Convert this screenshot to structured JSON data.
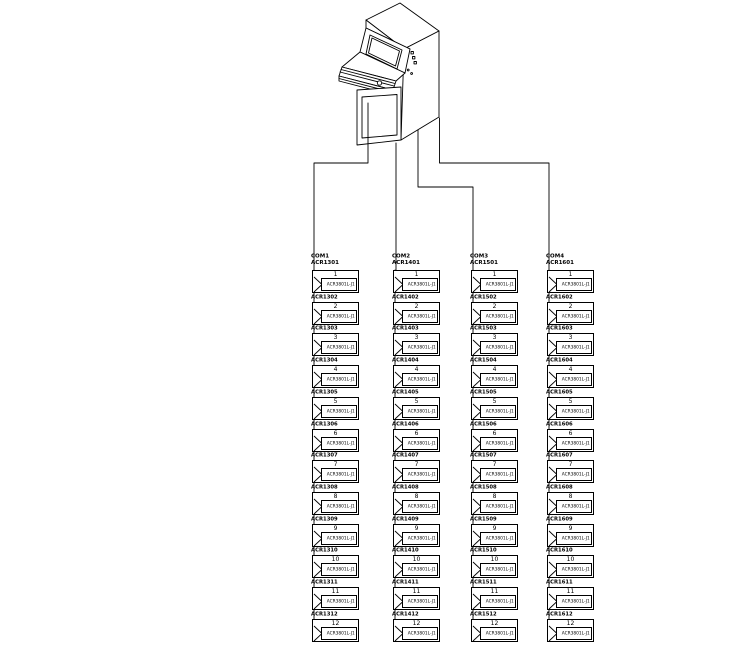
{
  "diagram": {
    "title": "operator-console-to-reader-loops wiring diagram",
    "console": {
      "name": "operator-console"
    },
    "line_color": "#000000",
    "background": "#ffffff",
    "columns": [
      {
        "com": "COM1",
        "units": [
          {
            "no": "1",
            "tag": "ACR1301",
            "model": "ACR3801L-J1"
          },
          {
            "no": "2",
            "tag": "ACR1302",
            "model": "ACR3801L-J1"
          },
          {
            "no": "3",
            "tag": "ACR1303",
            "model": "ACR3801L-J1"
          },
          {
            "no": "4",
            "tag": "ACR1304",
            "model": "ACR3801L-J1"
          },
          {
            "no": "5",
            "tag": "ACR1305",
            "model": "ACR3801L-J1"
          },
          {
            "no": "6",
            "tag": "ACR1306",
            "model": "ACR3801L-J1"
          },
          {
            "no": "7",
            "tag": "ACR1307",
            "model": "ACR3801L-J1"
          },
          {
            "no": "8",
            "tag": "ACR1308",
            "model": "ACR3801L-J1"
          },
          {
            "no": "9",
            "tag": "ACR1309",
            "model": "ACR3801L-J1"
          },
          {
            "no": "10",
            "tag": "ACR1310",
            "model": "ACR3801L-J1"
          },
          {
            "no": "11",
            "tag": "ACR1311",
            "model": "ACR3801L-J1"
          },
          {
            "no": "12",
            "tag": "ACR1312",
            "model": "ACR3801L-J1"
          }
        ]
      },
      {
        "com": "COM2",
        "units": [
          {
            "no": "1",
            "tag": "ACR1401",
            "model": "ACR3801L-J1"
          },
          {
            "no": "2",
            "tag": "ACR1402",
            "model": "ACR3801L-J1"
          },
          {
            "no": "3",
            "tag": "ACR1403",
            "model": "ACR3801L-J1"
          },
          {
            "no": "4",
            "tag": "ACR1404",
            "model": "ACR3801L-J1"
          },
          {
            "no": "5",
            "tag": "ACR1405",
            "model": "ACR3801L-J1"
          },
          {
            "no": "6",
            "tag": "ACR1406",
            "model": "ACR3801L-J1"
          },
          {
            "no": "7",
            "tag": "ACR1407",
            "model": "ACR3801L-J1"
          },
          {
            "no": "8",
            "tag": "ACR1408",
            "model": "ACR3801L-J1"
          },
          {
            "no": "9",
            "tag": "ACR1409",
            "model": "ACR3801L-J1"
          },
          {
            "no": "10",
            "tag": "ACR1410",
            "model": "ACR3801L-J1"
          },
          {
            "no": "11",
            "tag": "ACR1411",
            "model": "ACR3801L-J1"
          },
          {
            "no": "12",
            "tag": "ACR1412",
            "model": "ACR3801L-J1"
          }
        ]
      },
      {
        "com": "COM3",
        "units": [
          {
            "no": "1",
            "tag": "ACR1501",
            "model": "ACR3801L-J1"
          },
          {
            "no": "2",
            "tag": "ACR1502",
            "model": "ACR3801L-J1"
          },
          {
            "no": "3",
            "tag": "ACR1503",
            "model": "ACR3801L-J1"
          },
          {
            "no": "4",
            "tag": "ACR1504",
            "model": "ACR3801L-J1"
          },
          {
            "no": "5",
            "tag": "ACR1505",
            "model": "ACR3801L-J1"
          },
          {
            "no": "6",
            "tag": "ACR1506",
            "model": "ACR3801L-J1"
          },
          {
            "no": "7",
            "tag": "ACR1507",
            "model": "ACR3801L-J1"
          },
          {
            "no": "8",
            "tag": "ACR1508",
            "model": "ACR3801L-J1"
          },
          {
            "no": "9",
            "tag": "ACR1509",
            "model": "ACR3801L-J1"
          },
          {
            "no": "10",
            "tag": "ACR1510",
            "model": "ACR3801L-J1"
          },
          {
            "no": "11",
            "tag": "ACR1511",
            "model": "ACR3801L-J1"
          },
          {
            "no": "12",
            "tag": "ACR1512",
            "model": "ACR3801L-J1"
          }
        ]
      },
      {
        "com": "COM4",
        "units": [
          {
            "no": "1",
            "tag": "ACR1601",
            "model": "ACR3801L-J1"
          },
          {
            "no": "2",
            "tag": "ACR1602",
            "model": "ACR3801L-J1"
          },
          {
            "no": "3",
            "tag": "ACR1603",
            "model": "ACR3801L-J1"
          },
          {
            "no": "4",
            "tag": "ACR1604",
            "model": "ACR3801L-J1"
          },
          {
            "no": "5",
            "tag": "ACR1605",
            "model": "ACR3801L-J1"
          },
          {
            "no": "6",
            "tag": "ACR1606",
            "model": "ACR3801L-J1"
          },
          {
            "no": "7",
            "tag": "ACR1607",
            "model": "ACR3801L-J1"
          },
          {
            "no": "8",
            "tag": "ACR1608",
            "model": "ACR3801L-J1"
          },
          {
            "no": "9",
            "tag": "ACR1609",
            "model": "ACR3801L-J1"
          },
          {
            "no": "10",
            "tag": "ACR1610",
            "model": "ACR3801L-J1"
          },
          {
            "no": "11",
            "tag": "ACR1611",
            "model": "ACR3801L-J1"
          },
          {
            "no": "12",
            "tag": "ACR1612",
            "model": "ACR3801L-J1"
          }
        ]
      }
    ]
  }
}
